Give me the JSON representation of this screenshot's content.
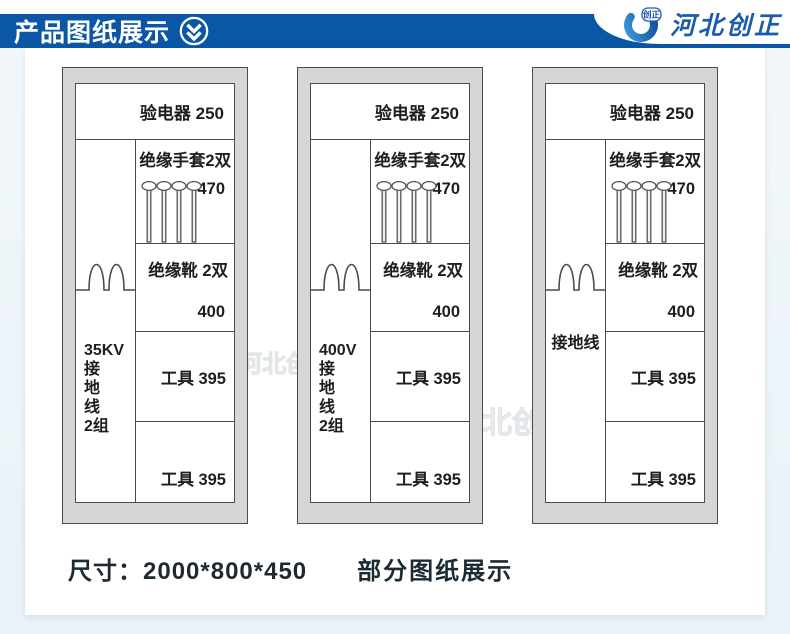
{
  "header": {
    "title": "产品图纸展示",
    "logo_badge": "创正",
    "logo_company": "河北创正"
  },
  "colors": {
    "header_blue": "#0b57a5",
    "logo_blue": "#1a5cab",
    "cabinet_fill": "#d6d6d6",
    "line_color": "#4c4c4c",
    "footer_text": "#1b2a33"
  },
  "cabinets": [
    {
      "top_label": "验电器 250",
      "left_lines": [
        "35KV",
        "接",
        "地",
        "线",
        "2组"
      ],
      "gloves_label": "绝缘手套2双",
      "gloves_value": "470",
      "boots_label": "绝缘靴 2双",
      "boots_value": "400",
      "tool1_label": "工具 395",
      "tool2_label": "工具 395"
    },
    {
      "top_label": "验电器 250",
      "left_lines": [
        "400V",
        "接",
        "地",
        "线",
        "2组"
      ],
      "gloves_label": "绝缘手套2双",
      "gloves_value": "470",
      "boots_label": "绝缘靴 2双",
      "boots_value": "400",
      "tool1_label": "工具 395",
      "tool2_label": "工具 395"
    },
    {
      "top_label": "验电器 250",
      "left_lines": [
        "接地线"
      ],
      "gloves_label": "绝缘手套2双",
      "gloves_value": "470",
      "boots_label": "绝缘靴 2双",
      "boots_value": "400",
      "tool1_label": "工具 395",
      "tool2_label": "工具 395"
    }
  ],
  "footer": {
    "size_label": "尺寸：2000*800*450",
    "caption": "部分图纸展示"
  },
  "watermark": "河北创正"
}
